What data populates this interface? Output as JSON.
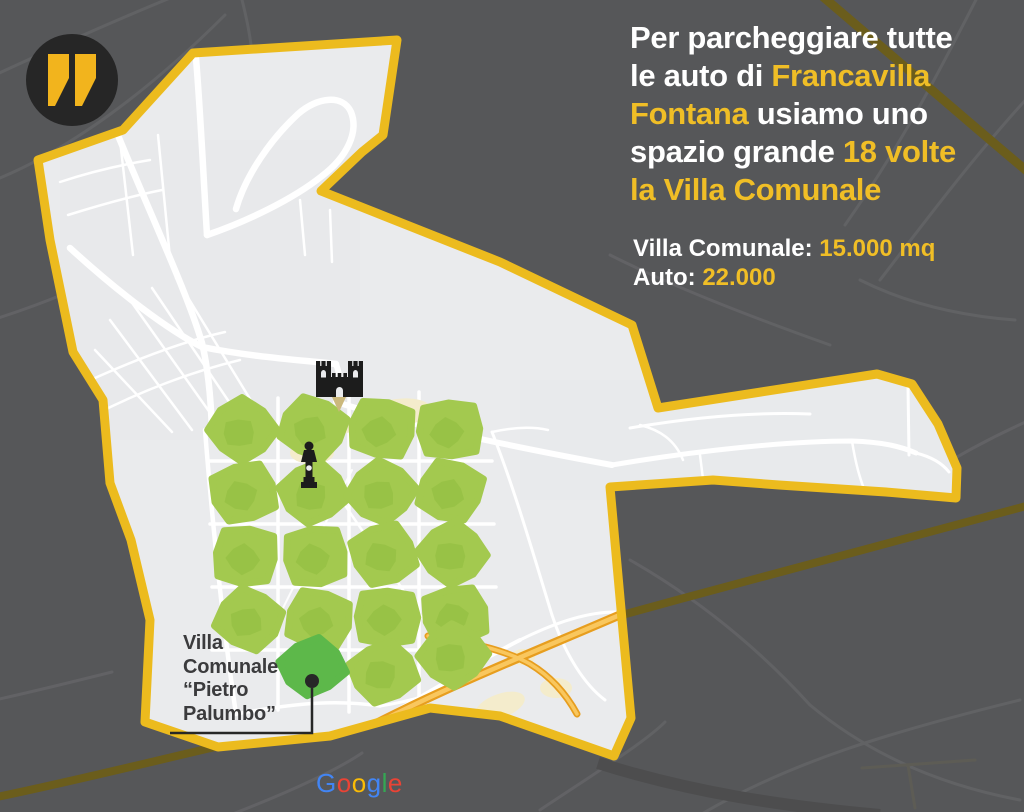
{
  "colors": {
    "background": "#565759",
    "faint_road": "#646467",
    "olive_road": "#6B5D1C",
    "boundary_yellow": "#ECBB1E",
    "map_fill": "#EAEBED",
    "road_white": "#FFFFFF",
    "beige_landmark": "#F4ECCC",
    "orange_road_casing": "#E79E1F",
    "orange_road_core": "#F9C75E",
    "patch_green": "#A3C94F",
    "patch_green_dark": "#8CBA3C",
    "villa_green": "#5DB84A",
    "icon_black": "#1C1C1C",
    "quote_circle": "#262626",
    "quote_yellow": "#F2B41D",
    "text_yellow": "#F0BE26",
    "text_white": "#FFFFFF",
    "map_label_dark": "#3B3B3D"
  },
  "headline": {
    "lines": [
      [
        {
          "t": "Per parcheggiare tutte",
          "y": false
        }
      ],
      [
        {
          "t": "le auto di ",
          "y": false
        },
        {
          "t": "Francavilla",
          "y": true
        }
      ],
      [
        {
          "t": "Fontana",
          "y": true
        },
        {
          "t": " usiamo uno",
          "y": false
        }
      ],
      [
        {
          "t": "spazio grande ",
          "y": false
        },
        {
          "t": "18 volte",
          "y": true
        }
      ],
      [
        {
          "t": "la Villa Comunale",
          "y": true
        }
      ]
    ]
  },
  "stats": {
    "lines": [
      [
        {
          "t": "Villa Comunale: ",
          "y": false
        },
        {
          "t": "15.000 mq",
          "y": true
        }
      ],
      [
        {
          "t": "Auto: ",
          "y": false
        },
        {
          "t": "22.000",
          "y": true
        }
      ]
    ]
  },
  "map": {
    "villa_label_lines": [
      "Villa",
      "Comunale",
      "“Pietro",
      "Palumbo”"
    ],
    "attribution_letters": [
      {
        "ch": "G",
        "c": "#4285F4"
      },
      {
        "ch": "o",
        "c": "#EA4335"
      },
      {
        "ch": "o",
        "c": "#FBBC05"
      },
      {
        "ch": "g",
        "c": "#4285F4"
      },
      {
        "ch": "l",
        "c": "#34A853"
      },
      {
        "ch": "e",
        "c": "#EA4335"
      }
    ],
    "green_patch_count": 18,
    "green_patches": [
      [
        242,
        430
      ],
      [
        313,
        428
      ],
      [
        382,
        429
      ],
      [
        450,
        430
      ],
      [
        244,
        493
      ],
      [
        314,
        493
      ],
      [
        382,
        492
      ],
      [
        451,
        491
      ],
      [
        246,
        556
      ],
      [
        316,
        556
      ],
      [
        384,
        554
      ],
      [
        453,
        553
      ],
      [
        249,
        619
      ],
      [
        319,
        619
      ],
      [
        387,
        617
      ],
      [
        455,
        615
      ],
      [
        383,
        672
      ],
      [
        453,
        655
      ]
    ],
    "patch_radius": [
      33,
      30
    ],
    "villa_patch": [
      313,
      667,
      32,
      28
    ],
    "marker": {
      "dot": [
        312,
        681
      ],
      "leader": [
        [
          170,
          733
        ],
        [
          312,
          733
        ],
        [
          312,
          688
        ]
      ]
    }
  }
}
